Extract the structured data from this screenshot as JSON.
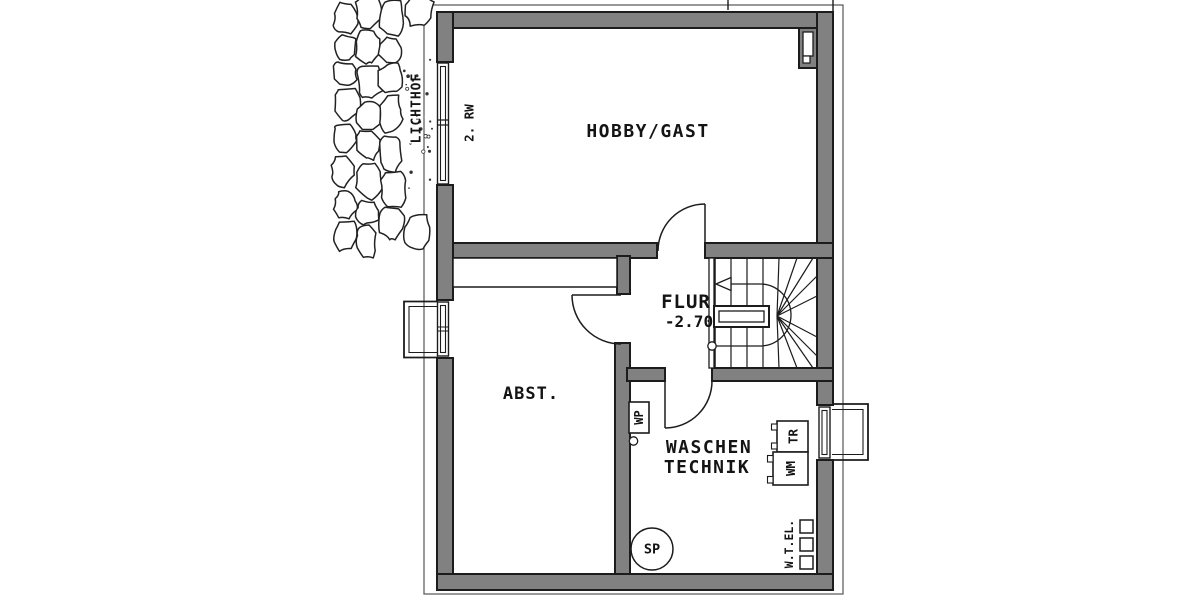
{
  "colors": {
    "background": "#ffffff",
    "wall_fill": "#818181",
    "line_color": "#1c1c1c",
    "text_color": "#141414",
    "boundary_color": "#555555"
  },
  "rooms": {
    "hobby_gast": {
      "label": "HOBBY/GAST"
    },
    "flur": {
      "label": "FLUR",
      "level": "-2.70"
    },
    "abstellraum": {
      "label": "ABST."
    },
    "waschen_technik": {
      "line1": "WASCHEN",
      "line2": "TECHNIK"
    }
  },
  "fixtures": {
    "heat_pump": {
      "label": "WP"
    },
    "dryer": {
      "label": "TR"
    },
    "washing_machine": {
      "label": "WM"
    },
    "sump_pump": {
      "label": "SP"
    },
    "utility_connections": {
      "label": "W.T.EL."
    }
  },
  "annotations": {
    "light_well": {
      "label": "LICHTHOF"
    },
    "escape_window": {
      "label": "2. RW"
    }
  }
}
